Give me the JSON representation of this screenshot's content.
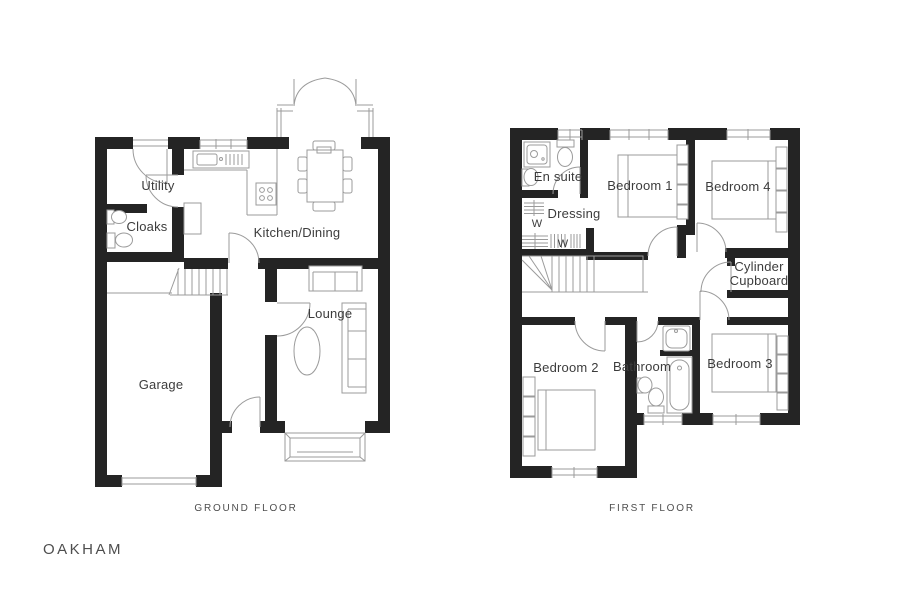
{
  "title": "OAKHAM",
  "colors": {
    "wall": "#242424",
    "line": "#9b9b9b",
    "hatch": "#cccccc",
    "text": "#3c3c3c",
    "caption": "#4e4e4e",
    "background": "#ffffff"
  },
  "ground_floor": {
    "caption": "GROUND FLOOR",
    "rooms": {
      "utility": "Utility",
      "cloaks": "Cloaks",
      "kitchen_dining": "Kitchen/Dining",
      "lounge": "Lounge",
      "garage": "Garage"
    }
  },
  "first_floor": {
    "caption": "FIRST FLOOR",
    "rooms": {
      "en_suite": "En suite",
      "dressing": "Dressing",
      "bedroom_1": "Bedroom 1",
      "bedroom_4": "Bedroom 4",
      "cylinder_line1": "Cylinder",
      "cylinder_line2": "Cupboard",
      "bedroom_2": "Bedroom 2",
      "bathroom": "Bathroom",
      "bedroom_3": "Bedroom 3",
      "wardrobe": "W"
    }
  }
}
